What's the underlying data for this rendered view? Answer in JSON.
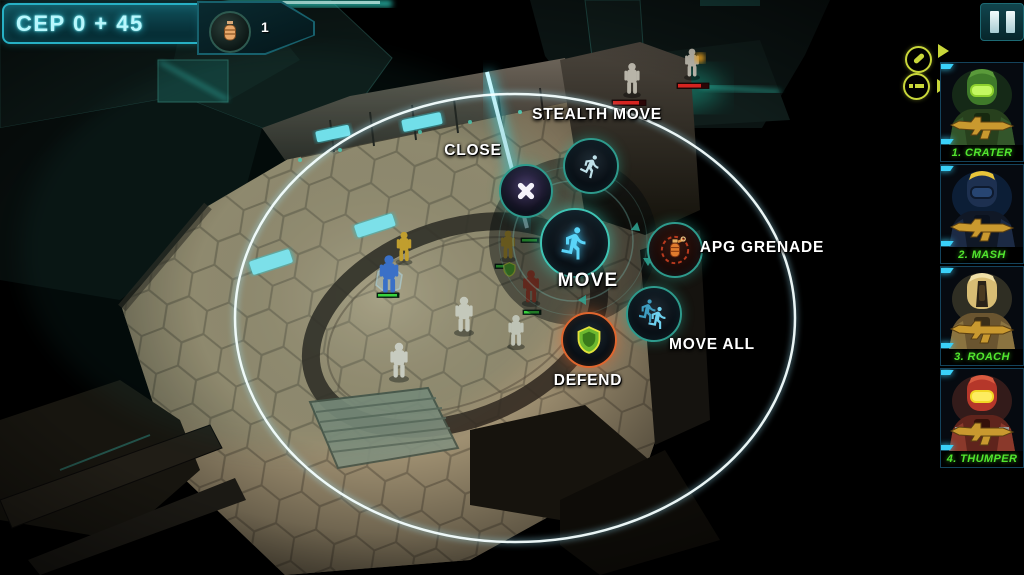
{
  "hud": {
    "cep_label": "CEP 0 + 45",
    "grenade_count": "1",
    "pause_icon": "pause-icon",
    "item_badges": [
      {
        "icon": "grenade-item-icon"
      },
      {
        "icon": "ammo-item-icon"
      }
    ]
  },
  "radial_menu": {
    "actions": [
      {
        "id": "close",
        "label": "CLOSE",
        "icon": "close-x-icon"
      },
      {
        "id": "stealth_move",
        "label": "STEALTH MOVE",
        "icon": "stealth-runner-icon"
      },
      {
        "id": "move",
        "label": "MOVE",
        "icon": "runner-icon"
      },
      {
        "id": "apg_grenade",
        "label": "APG GRENADE",
        "icon": "grenade-icon"
      },
      {
        "id": "move_all",
        "label": "MOVE ALL",
        "icon": "double-runner-icon"
      },
      {
        "id": "defend",
        "label": "DEFEND",
        "icon": "shield-icon"
      }
    ]
  },
  "roster": {
    "units": [
      {
        "label": "1. CRATER",
        "color": "#3f7a2a"
      },
      {
        "label": "2. MASH",
        "color": "#1d3050"
      },
      {
        "label": "3. ROACH",
        "color": "#d8bd74"
      },
      {
        "label": "4. THUMPER",
        "color": "#b5372a"
      }
    ]
  },
  "scene": {
    "ally_units": 4,
    "civilian_units": 3,
    "enemy_units": 2,
    "defend_status_icon": "shield-status-icon"
  },
  "colors": {
    "hud_accent": "#2fd8e8",
    "badge_yellow": "#c9d73a",
    "roster_label_green": "#52e62e",
    "defend_ring_orange": "#e0662e",
    "menu_ring_teal": "#2e9a8c",
    "move_icon_cyan": "#5ad4f8",
    "ally_health_green": "#3de43a",
    "enemy_health_red": "#d42020",
    "selection_ring_white": "#ffffff"
  }
}
